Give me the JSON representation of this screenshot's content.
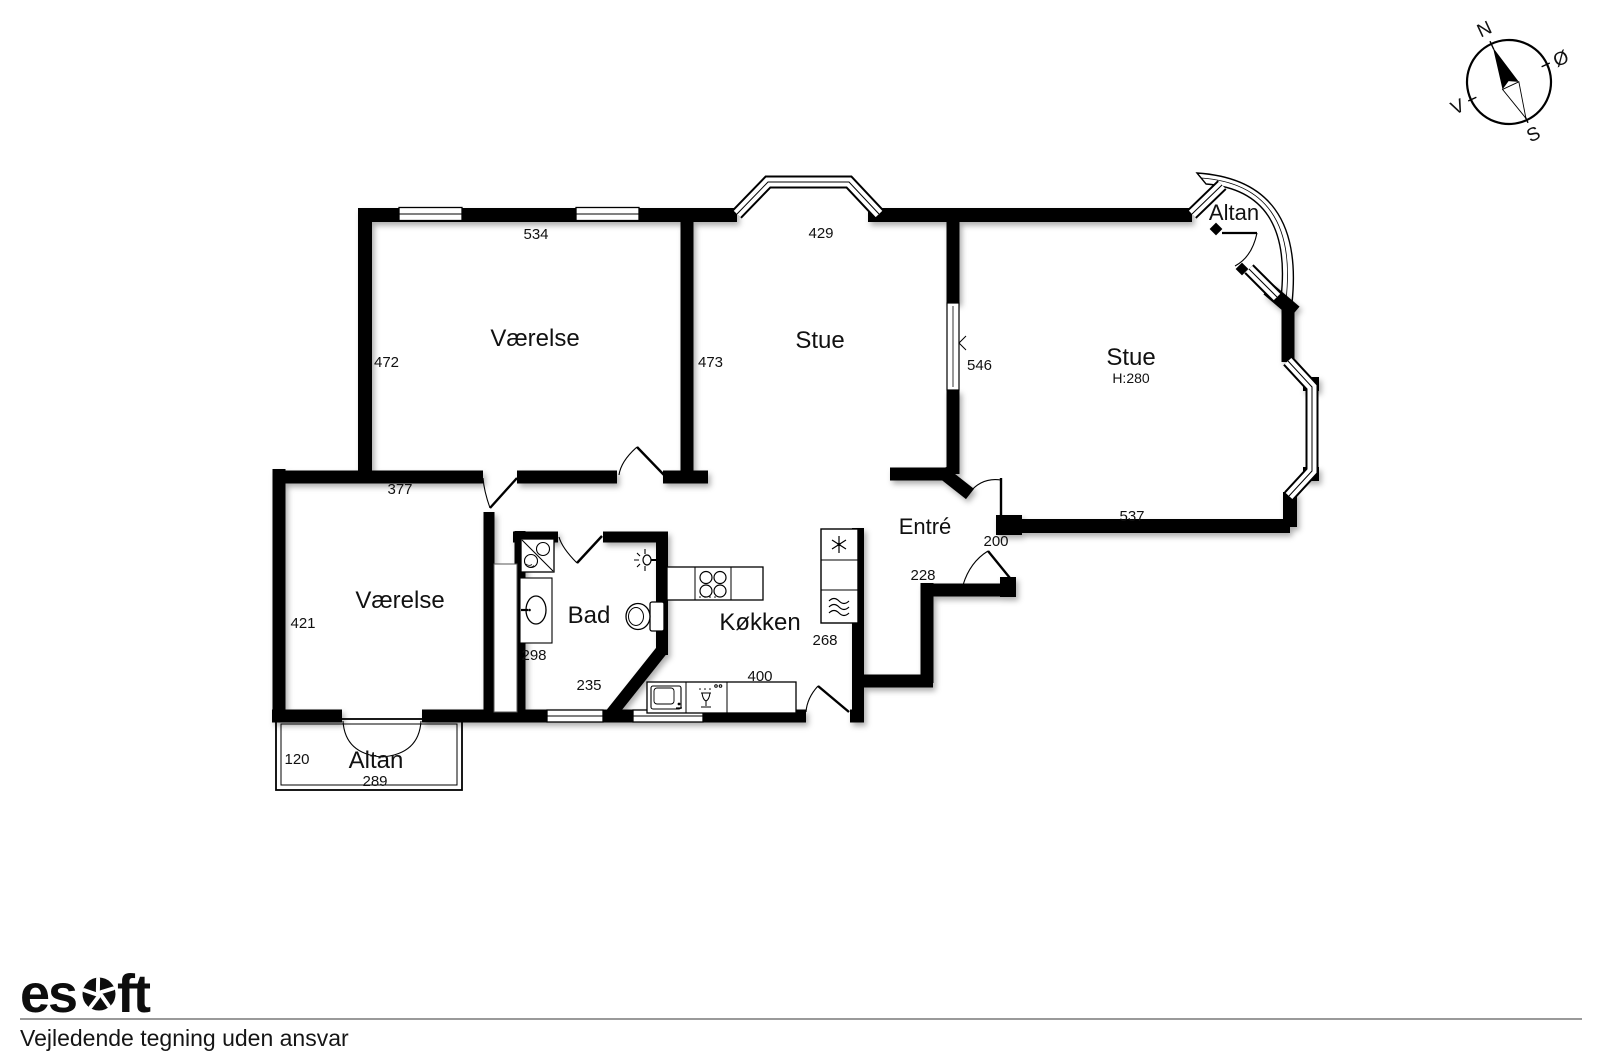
{
  "compass": {
    "north": "N",
    "east": "Ø",
    "south": "S",
    "west": "V"
  },
  "rooms": {
    "bedroom_top": "Værelse",
    "living_mid": "Stue",
    "living_right": "Stue",
    "living_right_height": "H:280",
    "bedroom_bottom": "Værelse",
    "bath": "Bad",
    "kitchen": "Køkken",
    "entry": "Entré",
    "balcony_top": "Altan",
    "balcony_bottom": "Altan"
  },
  "dimensions": {
    "top_bedroom_width": "534",
    "top_bedroom_left": "472",
    "top_bedroom_right": "473",
    "living_mid_width": "429",
    "living_divider": "546",
    "living_right_width": "537",
    "hall_width": "377",
    "bedroom_bottom_height": "421",
    "bath_left": "298",
    "bath_width": "235",
    "kitchen_width": "400",
    "entry_fridge": "268",
    "entry_width": "228",
    "entry_door": "200",
    "balcony_depth": "120",
    "balcony_width": "289"
  },
  "icons": {
    "compass": "compass-rose",
    "freezer": "snowflake",
    "washing_machine": "waves",
    "stove": "four-burners",
    "sink": "basin-with-tap",
    "dishwasher": "glass-with-dots",
    "toilet": "toilet",
    "washbasin": "oval-basin",
    "washer_dryer": "square-diagonal-two-drums",
    "lamp": "wall-light",
    "logo_gear": "aperture-gear"
  },
  "footer": {
    "brand_prefix": "es",
    "brand_suffix": "ft",
    "disclaimer": "Vejledende tegning uden ansvar"
  }
}
